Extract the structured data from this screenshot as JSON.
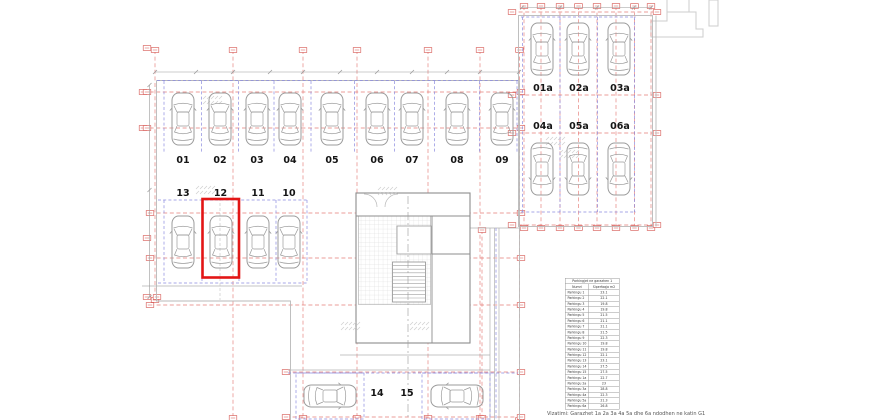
{
  "spots": {
    "row_top": [
      "01",
      "02",
      "03",
      "04",
      "05",
      "06",
      "07",
      "08",
      "09"
    ],
    "row_middle": [
      "13",
      "12",
      "11",
      "10"
    ],
    "annex_top": [
      "01a",
      "02a",
      "03a"
    ],
    "annex_bottom": [
      "04a",
      "05a",
      "06a"
    ],
    "row_bottom": [
      "14",
      "15"
    ],
    "highlighted": "12"
  },
  "colors": {
    "highlight": "#e31515",
    "grid": "#e57c78",
    "marker": "#d4504c",
    "stall": "#8b8bdf",
    "car": "#9b9b9b"
  },
  "table": {
    "title": "Parkingjet ne garazhen 1",
    "columns": [
      "Numri",
      "Siperfaqja m2"
    ],
    "rows": [
      {
        "name": "Parkingu 1",
        "area": "23.1"
      },
      {
        "name": "Parkingu 2",
        "area": "22.1"
      },
      {
        "name": "Parkingu 3",
        "area": "19.8"
      },
      {
        "name": "Parkingu 4",
        "area": "19.8"
      },
      {
        "name": "Parkingu 5",
        "area": "21.5"
      },
      {
        "name": "Parkingu 6",
        "area": "21.1"
      },
      {
        "name": "Parkingu 7",
        "area": "21.1"
      },
      {
        "name": "Parkingu 8",
        "area": "21.5"
      },
      {
        "name": "Parkingu 9",
        "area": "22.3"
      },
      {
        "name": "Parkingu 10",
        "area": "19.8"
      },
      {
        "name": "Parkingu 11",
        "area": "19.8"
      },
      {
        "name": "Parkingu 12",
        "area": "22.1"
      },
      {
        "name": "Parkingu 13",
        "area": "23.1"
      },
      {
        "name": "Parkingu 14",
        "area": "27.5"
      },
      {
        "name": "Parkingu 15",
        "area": "27.5"
      },
      {
        "name": "Parkingu 1a",
        "area": "22.7"
      },
      {
        "name": "Parkingu 2a",
        "area": "23"
      },
      {
        "name": "Parkingu 3a",
        "area": "28.8"
      },
      {
        "name": "Parkingu 4a",
        "area": "22.3"
      },
      {
        "name": "Parkingu 5a",
        "area": "21.3"
      },
      {
        "name": "Parkingu 6a",
        "area": "26.8"
      }
    ]
  },
  "caption": "Vizatimi: Garazhet 1a 2a 3a 4a 5a dhe 6a ndodhen ne katin G1"
}
